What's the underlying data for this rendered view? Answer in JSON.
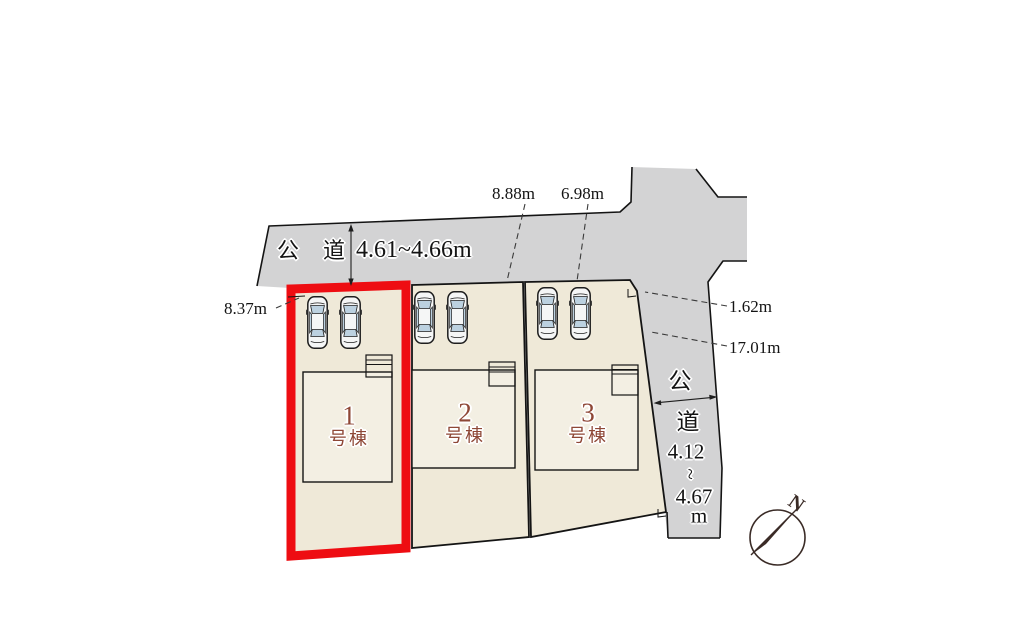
{
  "labels": {
    "road_top_name": "公道",
    "road_top_width": "4.61~4.66m",
    "dim_top_left": "8.88m",
    "dim_top_right": "6.98m",
    "dim_left": "8.37m",
    "dim_right_upper": "1.62m",
    "dim_right_lower": "17.01m",
    "road_right_char1": "公",
    "road_right_char2": "道",
    "road_right_num1": "4.12",
    "road_right_tilde": "~",
    "road_right_num2": "4.67",
    "road_right_unit": "m",
    "compass_north": "N"
  },
  "lots": {
    "lot1": {
      "number": "1",
      "suffix": "号棟",
      "highlighted": true
    },
    "lot2": {
      "number": "2",
      "suffix": "号棟",
      "highlighted": false
    },
    "lot3": {
      "number": "3",
      "suffix": "号棟",
      "highlighted": false
    }
  },
  "colors": {
    "road_fill": "#d3d3d4",
    "lot_fill": "#efe9d8",
    "building_fill": "#f3efe3",
    "highlight_red": "#ee0d12",
    "lot_label_brown": "#8e4736",
    "car_window_blue": "#bcd1e0",
    "outline_black": "#141414"
  }
}
